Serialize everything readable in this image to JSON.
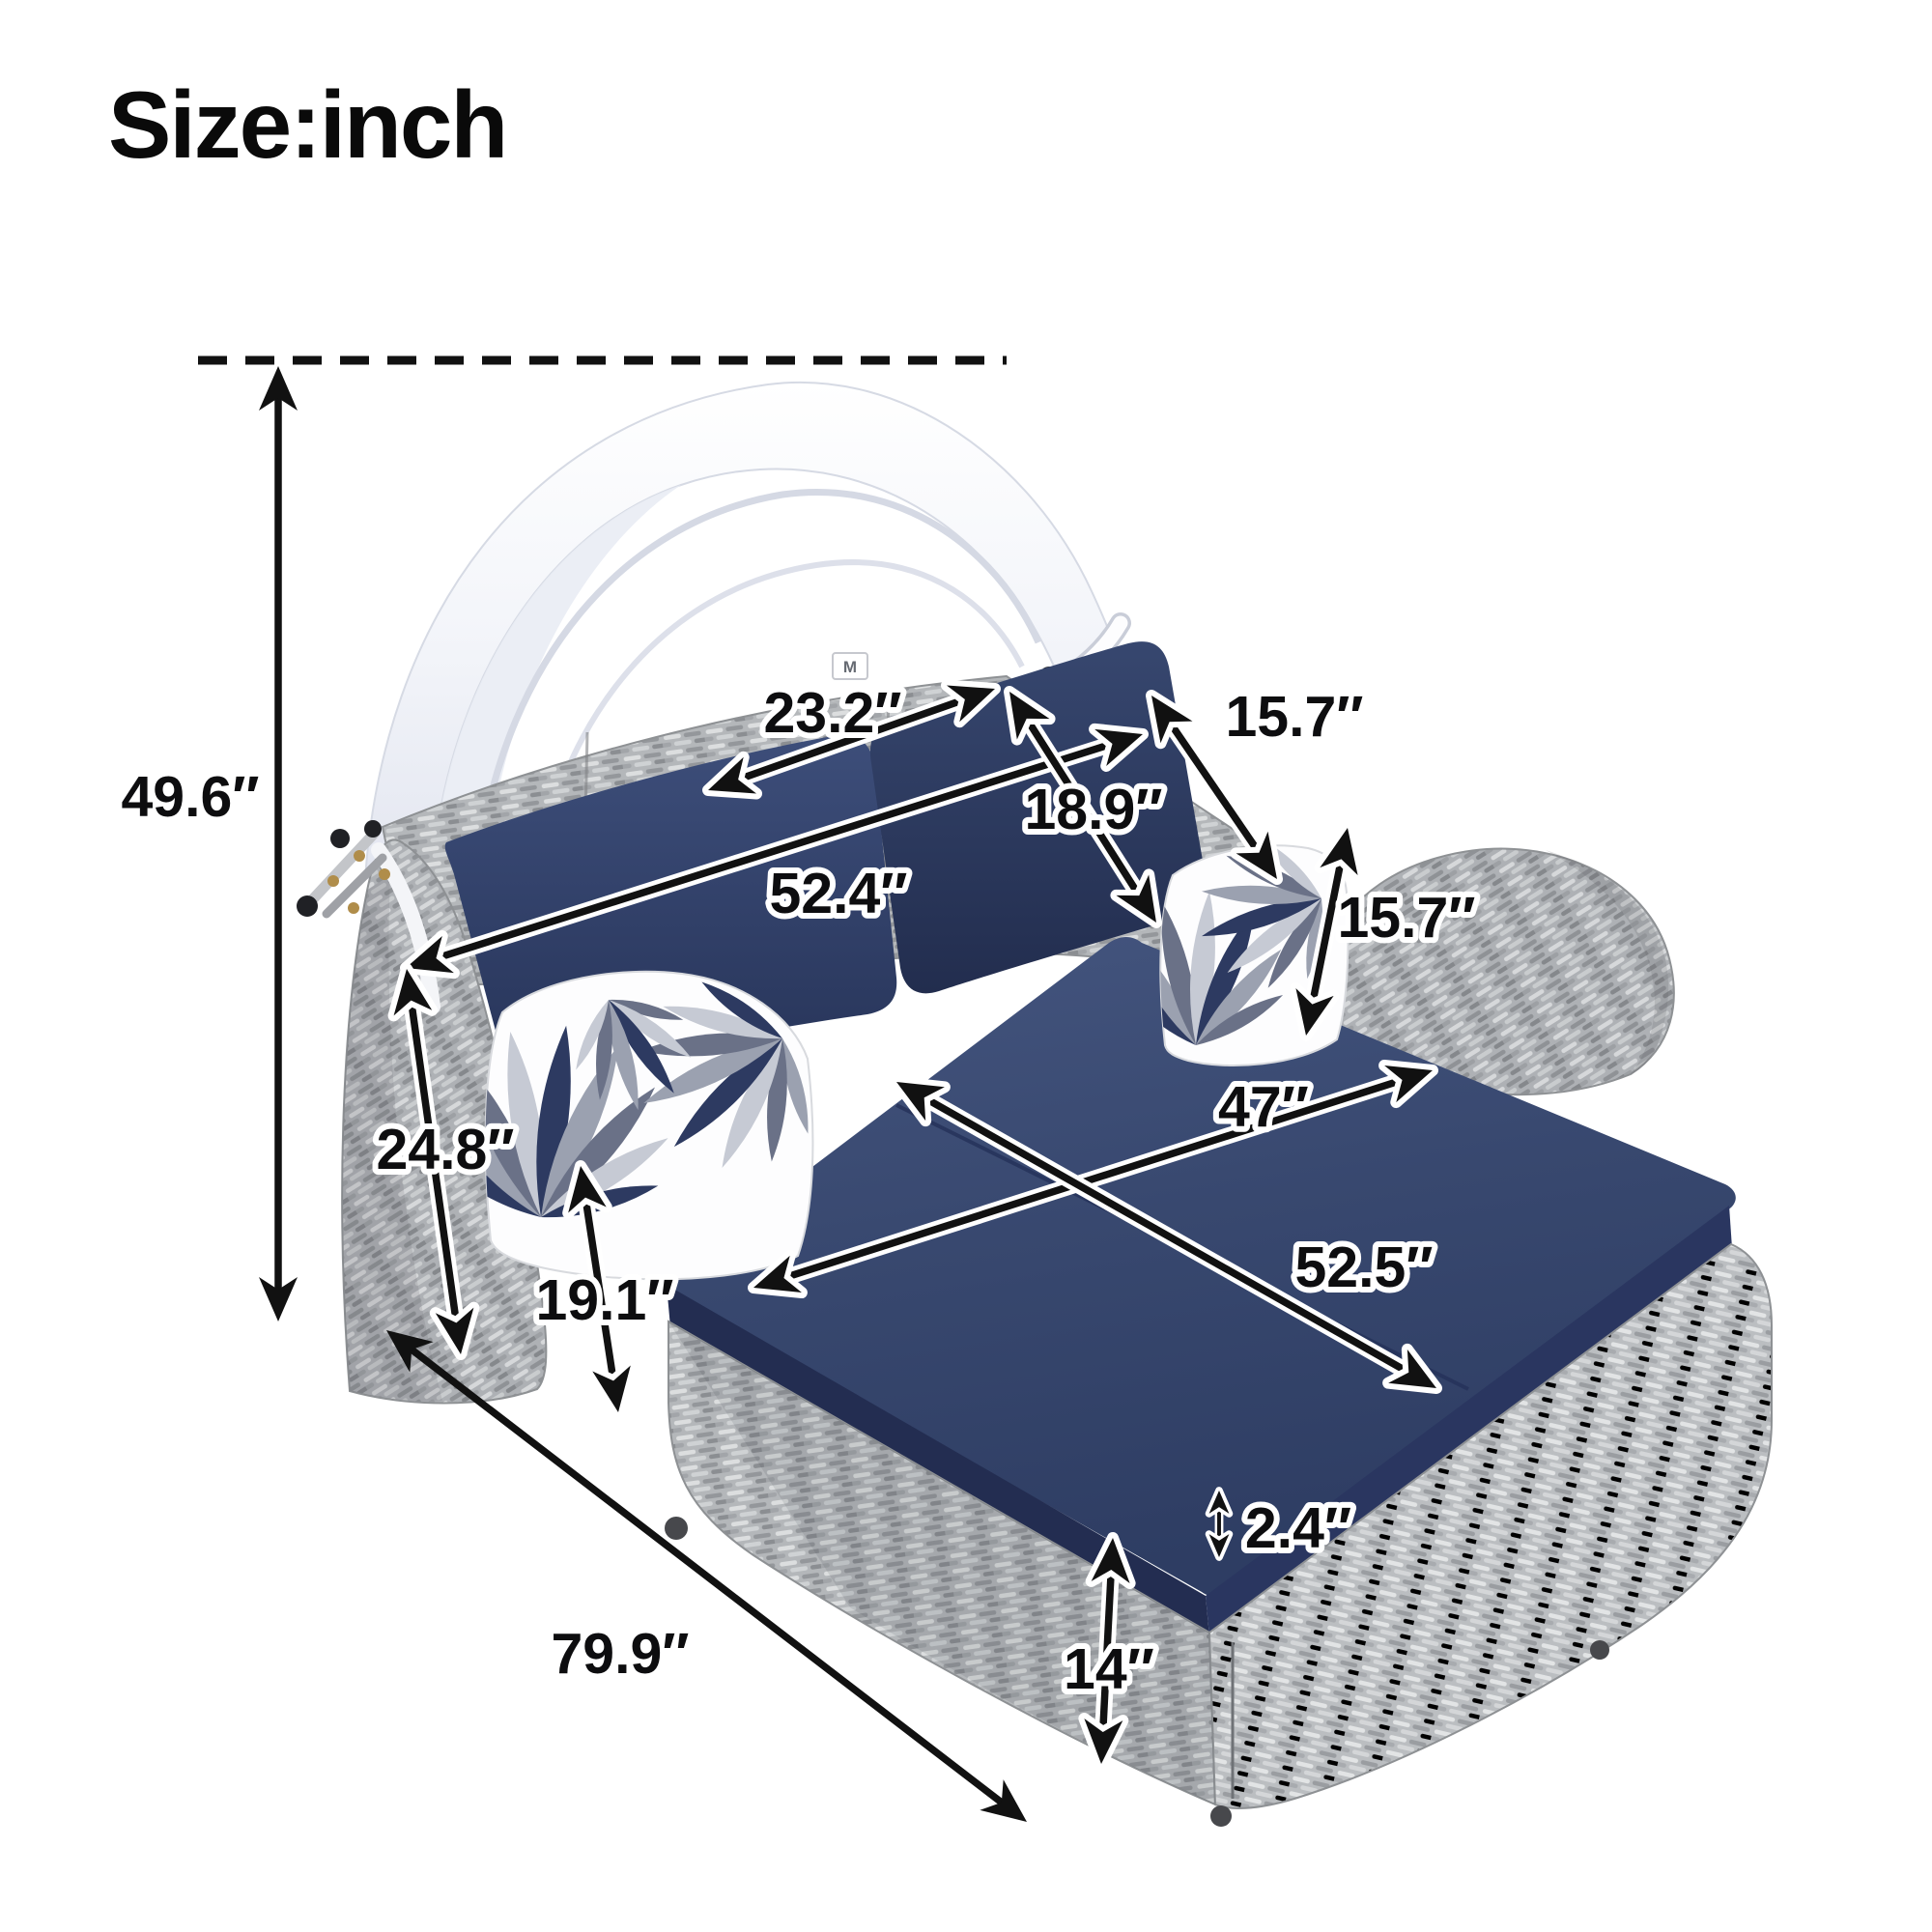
{
  "title": "Size:inch",
  "canopy_tag": "M",
  "dimensions": {
    "overall_height": "49.6″",
    "back_section_left": "23.2″",
    "pillow_width": "15.7″",
    "back_section_right": "18.9″",
    "backrest_width": "52.4″",
    "pillow_height": "15.7″",
    "seat_width": "47″",
    "armrest_height": "24.8″",
    "side_height": "19.1″",
    "seat_length": "52.5″",
    "overall_length": "79.9″",
    "cushion_thickness": "2.4″",
    "base_height": "14″"
  },
  "colors": {
    "cushion_navy": "#32426d",
    "cushion_navy_dark": "#273459",
    "wicker_grey": "#b4b7ba",
    "canopy_white": "#f7f8fb",
    "annotation_black": "#111111"
  }
}
